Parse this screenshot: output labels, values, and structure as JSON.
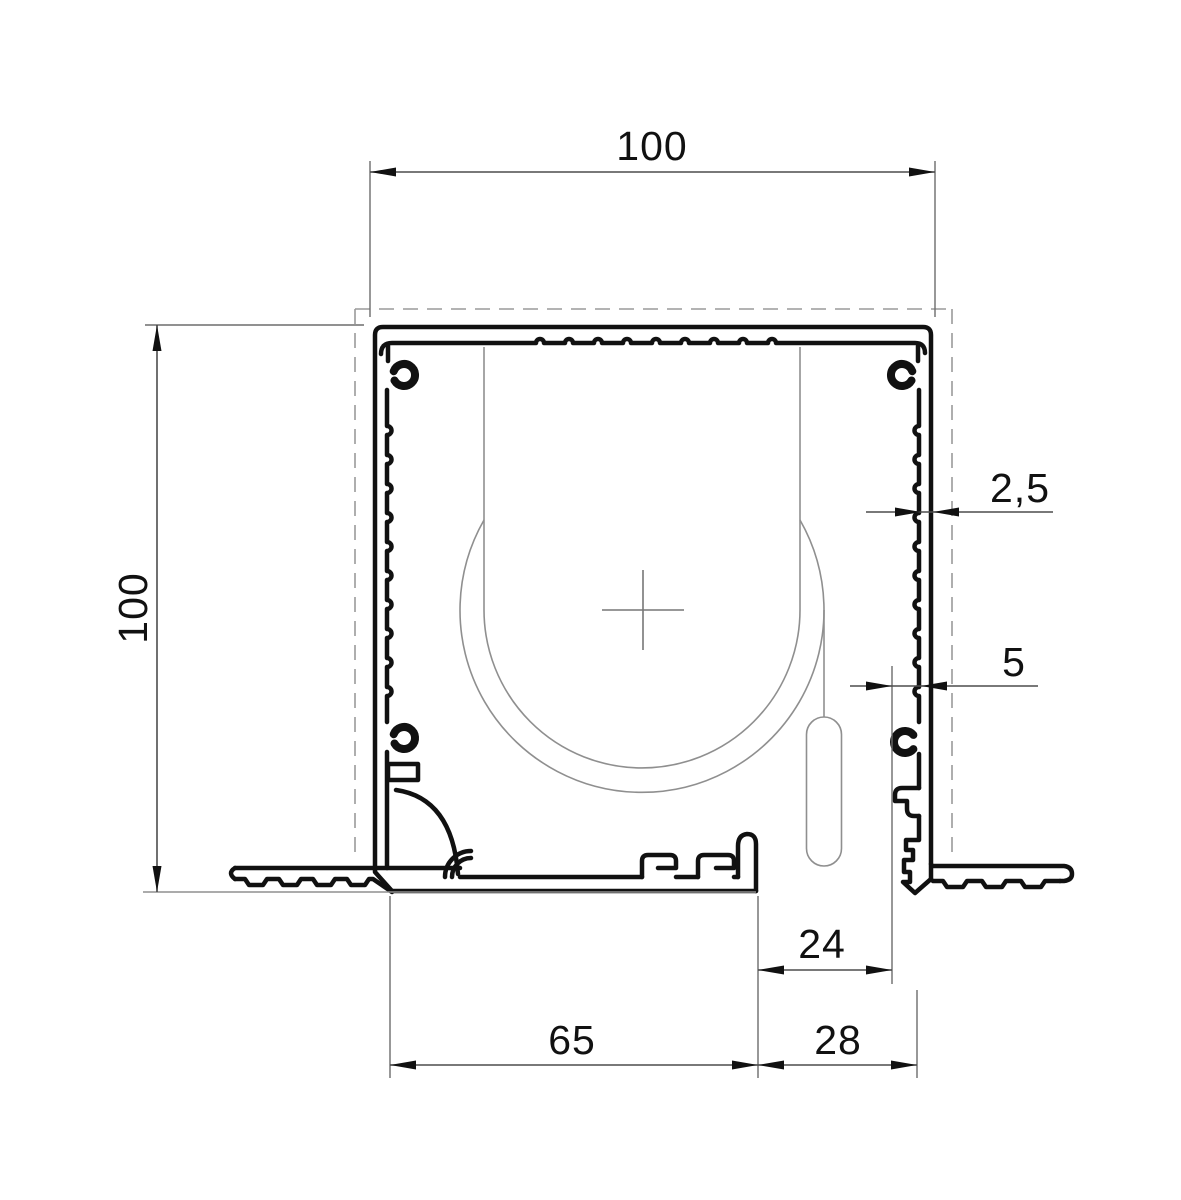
{
  "drawing": {
    "kind": "roller-blind recessed box profile cross-section",
    "dimensions": {
      "top_width": {
        "value": "100"
      },
      "side_height": {
        "value": "100"
      },
      "wall_thickness": {
        "value": "2,5"
      },
      "fabric_slot": {
        "value": "5"
      },
      "slot_offset": {
        "value": "24"
      },
      "bottom_inner_width": {
        "value": "65"
      },
      "bottom_right_width": {
        "value": "28"
      }
    },
    "colors": {
      "outline": "#111111",
      "dimension_lines": "#4d4d4d",
      "reference_geometry": "#8f8f8f",
      "dashed_recess": "#9a9a9a",
      "background": "#ffffff"
    }
  }
}
